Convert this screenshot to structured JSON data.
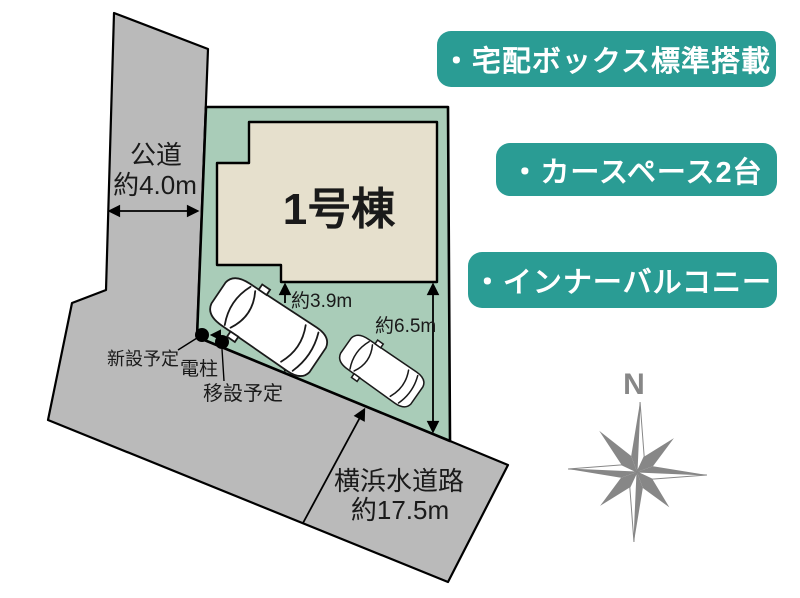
{
  "plan": {
    "building": {
      "label": "1号棟"
    },
    "road_left": {
      "name": "公道",
      "width": "約4.0m"
    },
    "road_bottom": {
      "name": "横浜水道路",
      "width": "約17.5m"
    },
    "dim_depth": "約3.9m",
    "dim_side": "約6.5m",
    "pole": {
      "new_label": "新設予定",
      "pole_label": "電柱",
      "move_label": "移設予定"
    },
    "compass_north": "N"
  },
  "features": [
    {
      "label": "・宅配ボックス標準搭載"
    },
    {
      "label": "・カースペース2台"
    },
    {
      "label": "・インナーバルコニー"
    }
  ],
  "colors": {
    "teal": "#2A9C94",
    "plot-green": "#A9CCB8",
    "building-beige": "#E6E0CD",
    "road-gray": "#BABABA",
    "compass-gray": "#878787",
    "outline-black": "#000000",
    "text-dark": "#1A1A1A"
  }
}
